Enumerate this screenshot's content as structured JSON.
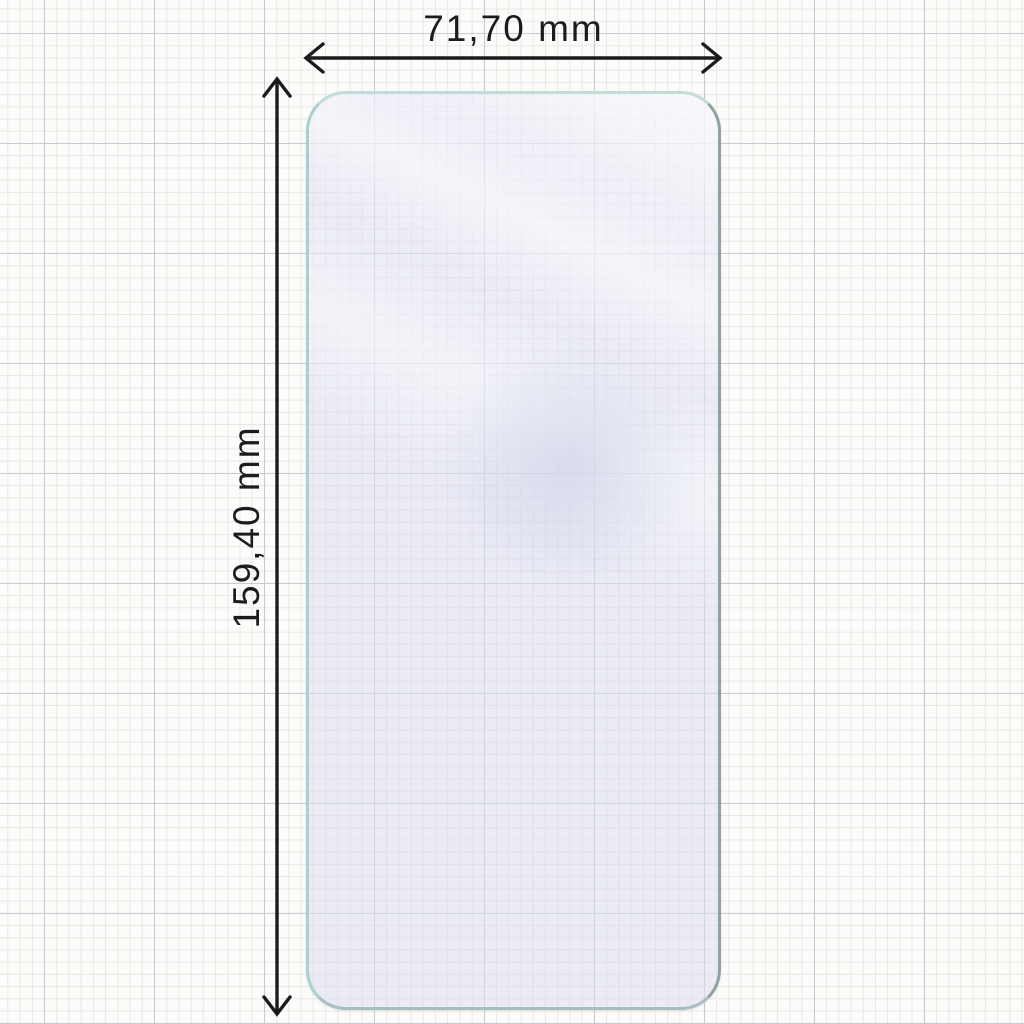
{
  "diagram": {
    "subject": "screen-protector-glass",
    "width_label": "71,70 mm",
    "height_label": "159,40 mm"
  },
  "icons": {
    "width_arrow": "double-headed-horizontal-arrow",
    "height_arrow": "double-headed-vertical-arrow"
  },
  "colors": {
    "label_text": "#1c1c1e",
    "arrow": "#1b1b1b",
    "glass_edge_light": "#a7d1ce",
    "glass_edge_dark": "#8da39e",
    "glass_tint": "#eaebf4",
    "paper": "#fcfcfb",
    "grid_minor": "#eae7e4",
    "grid_major": "#c9c9cd"
  }
}
